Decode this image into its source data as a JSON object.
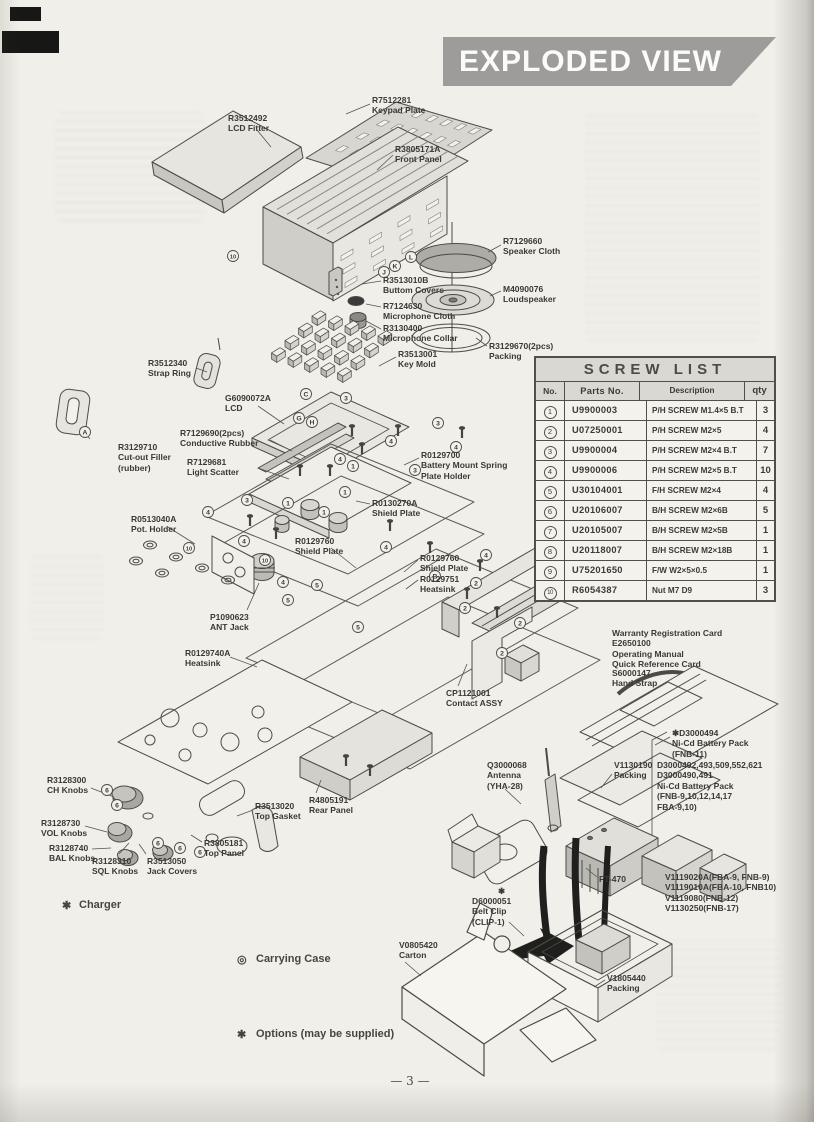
{
  "banner": {
    "title": "EXPLODED VIEW"
  },
  "page": {
    "number_text": "— 3 —"
  },
  "screw_table": {
    "title": "SCREW LIST",
    "columns": [
      "No.",
      "Parts No.",
      "Description",
      "qty"
    ],
    "rows": [
      {
        "no": "1",
        "part": "U9900003",
        "desc": "P/H SCREW M1.4×5 B.T",
        "qty": "3"
      },
      {
        "no": "2",
        "part": "U07250001",
        "desc": "P/H SCREW M2×5",
        "qty": "4"
      },
      {
        "no": "3",
        "part": "U9900004",
        "desc": "P/H SCREW M2×4 B.T",
        "qty": "7"
      },
      {
        "no": "4",
        "part": "U9900006",
        "desc": "P/H SCREW M2×5 B.T",
        "qty": "10"
      },
      {
        "no": "5",
        "part": "U30104001",
        "desc": "F/H SCREW M2×4",
        "qty": "4"
      },
      {
        "no": "6",
        "part": "U20106007",
        "desc": "B/H SCREW M2×6B",
        "qty": "5"
      },
      {
        "no": "7",
        "part": "U20105007",
        "desc": "B/H SCREW M2×5B",
        "qty": "1"
      },
      {
        "no": "8",
        "part": "U20118007",
        "desc": "B/H SCREW M2×18B",
        "qty": "1"
      },
      {
        "no": "9",
        "part": "U75201650",
        "desc": "F/W W2×5×0.5",
        "qty": "1"
      },
      {
        "no": "10",
        "part": "R6054387",
        "desc": "Nut M7 D9",
        "qty": "3"
      }
    ]
  },
  "diagram": {
    "labels": [
      {
        "id": "keypad-plate",
        "x": 372,
        "y": 95,
        "lines": [
          "R7512281",
          "Keypad Plate"
        ],
        "leader": [
          370,
          104,
          346,
          114
        ]
      },
      {
        "id": "lcd-fitter",
        "x": 228,
        "y": 113,
        "lines": [
          "R3512492",
          "LCD Fitter"
        ],
        "leader": [
          257,
          130,
          271,
          147
        ]
      },
      {
        "id": "front-panel",
        "x": 395,
        "y": 144,
        "lines": [
          "R3805171A",
          "Front Panel"
        ],
        "leader": [
          393,
          155,
          377,
          170
        ]
      },
      {
        "id": "speaker-cloth",
        "x": 503,
        "y": 236,
        "lines": [
          "R7129660",
          "Speaker Cloth"
        ],
        "leader": [
          501,
          245,
          488,
          252
        ]
      },
      {
        "id": "buttom-covers",
        "x": 383,
        "y": 275,
        "lines": [
          "R3513010B",
          "Buttom Covers"
        ],
        "leader": [
          381,
          281,
          362,
          284
        ]
      },
      {
        "id": "loudspeaker",
        "x": 503,
        "y": 284,
        "lines": [
          "M4090076",
          "Loudspeaker"
        ],
        "leader": [
          501,
          291,
          490,
          296
        ]
      },
      {
        "id": "microphone-cloth",
        "x": 383,
        "y": 301,
        "lines": [
          "R7124630",
          "Microphone Cloth"
        ],
        "leader": [
          381,
          307,
          366,
          304
        ]
      },
      {
        "id": "microphone-collar",
        "x": 383,
        "y": 323,
        "lines": [
          "R3130400",
          "Microphone Collar"
        ],
        "leader": [
          381,
          329,
          366,
          321
        ]
      },
      {
        "id": "packing-2pcs",
        "x": 489,
        "y": 341,
        "lines": [
          "R3129670(2pcs)",
          "Packing"
        ],
        "leader": [
          487,
          346,
          476,
          338
        ]
      },
      {
        "id": "key-mold",
        "x": 398,
        "y": 349,
        "lines": [
          "R3513001",
          "Key Mold"
        ],
        "leader": [
          396,
          357,
          379,
          366
        ]
      },
      {
        "id": "strap-ring",
        "x": 148,
        "y": 358,
        "lines": [
          "R3512340",
          "Strap Ring"
        ],
        "leader": [
          196,
          368,
          207,
          372
        ]
      },
      {
        "id": "lcd",
        "x": 225,
        "y": 393,
        "lines": [
          "G6090072A",
          "LCD"
        ],
        "leader": [
          258,
          406,
          284,
          424
        ]
      },
      {
        "id": "conductive-rubber",
        "x": 180,
        "y": 428,
        "lines": [
          "R7129690(2pcs)",
          "Conductive Rubber"
        ],
        "leader": [
          270,
          440,
          292,
          451
        ]
      },
      {
        "id": "cut-out-filler",
        "x": 118,
        "y": 442,
        "lines": [
          "R3129710",
          "Cut-out Filler",
          "(rubber)"
        ],
        "leader": [
          90,
          439,
          80,
          428
        ]
      },
      {
        "id": "light-scatter",
        "x": 187,
        "y": 457,
        "lines": [
          "R7129681",
          "Light Scatter"
        ],
        "leader": [
          258,
          468,
          289,
          479
        ]
      },
      {
        "id": "battery-mount-spring",
        "x": 421,
        "y": 450,
        "lines": [
          "R0129700",
          "Battery Mount Spring",
          "Plate Holder"
        ],
        "leader": [
          419,
          458,
          404,
          465
        ]
      },
      {
        "id": "shield-plate-a",
        "x": 372,
        "y": 498,
        "lines": [
          "R0130270A",
          "Shield Plate"
        ],
        "leader": [
          370,
          504,
          356,
          501
        ]
      },
      {
        "id": "pot-holder",
        "x": 131,
        "y": 514,
        "lines": [
          "R0513040A",
          "Pot. Holder"
        ],
        "leader": [
          168,
          527,
          195,
          544
        ]
      },
      {
        "id": "shield-plate-b",
        "x": 295,
        "y": 536,
        "lines": [
          "R0129760",
          "Shield Plate"
        ],
        "leader": [
          331,
          548,
          356,
          568
        ]
      },
      {
        "id": "shield-plate-c",
        "x": 420,
        "y": 553,
        "lines": [
          "R0129760",
          "Shield Plate"
        ],
        "leader": [
          418,
          560,
          404,
          572
        ]
      },
      {
        "id": "heatsink-a",
        "x": 420,
        "y": 574,
        "lines": [
          "R0129751",
          "Heatsink"
        ],
        "leader": [
          418,
          580,
          406,
          589
        ]
      },
      {
        "id": "ant-jack",
        "x": 210,
        "y": 612,
        "lines": [
          "P1090623",
          "ANT Jack"
        ],
        "leader": [
          247,
          610,
          259,
          583
        ]
      },
      {
        "id": "heatsink-b",
        "x": 185,
        "y": 648,
        "lines": [
          "R0129740A",
          "Heatsink"
        ],
        "leader": [
          230,
          657,
          257,
          667
        ]
      },
      {
        "id": "contact-assy",
        "x": 446,
        "y": 688,
        "lines": [
          "CP1121001",
          "Contact ASSY"
        ],
        "leader": [
          458,
          686,
          467,
          664
        ]
      },
      {
        "id": "documents",
        "x": 612,
        "y": 628,
        "lines": [
          "Warranty Registration Card",
          "E2650100",
          "Operating Manual",
          "Quick Reference Card"
        ],
        "leader": null
      },
      {
        "id": "hand-strap",
        "x": 612,
        "y": 668,
        "lines": [
          "S6000147",
          "Hand Strap"
        ],
        "leader": null
      },
      {
        "id": "battery-fnb11",
        "x": 672,
        "y": 728,
        "lines": [
          "✱D3000494",
          "Ni-Cd Battery Pack",
          "(FNB-11)"
        ],
        "leader": [
          670,
          737,
          655,
          745
        ]
      },
      {
        "id": "packing-v1130190",
        "x": 614,
        "y": 760,
        "lines": [
          "V1130190",
          "Packing"
        ],
        "leader": [
          612,
          774,
          601,
          788
        ]
      },
      {
        "id": "battery-multi",
        "x": 657,
        "y": 760,
        "lines": [
          "D3000492,493,509,552,621",
          "D3000490,491",
          "Ni-Cd Battery Pack",
          "(FNB-9,10,12,14,17",
          "FBA-9,10)"
        ],
        "leader": null
      },
      {
        "id": "antenna",
        "x": 487,
        "y": 760,
        "lines": [
          "Q3000068",
          "Antenna",
          "(YHA-28)"
        ],
        "leader": [
          505,
          789,
          521,
          804
        ]
      },
      {
        "id": "ft-470",
        "x": 599,
        "y": 874,
        "lines": [
          "FT-470"
        ],
        "leader": [
          597,
          877,
          586,
          868
        ]
      },
      {
        "id": "battery-variants",
        "x": 665,
        "y": 872,
        "lines": [
          "V1119020A(FBA-9, FNB-9)",
          "V1119010A(FBA-10, FNB10)",
          "V1119080(FNB-12)",
          "V1130250(FNB-17)"
        ],
        "leader": null
      },
      {
        "id": "ch-knobs",
        "x": 47,
        "y": 775,
        "lines": [
          "R3128300",
          "CH Knobs"
        ],
        "leader": [
          91,
          788,
          114,
          797
        ]
      },
      {
        "id": "vol-knobs",
        "x": 41,
        "y": 818,
        "lines": [
          "R3128730",
          "VOL Knobs"
        ],
        "leader": [
          85,
          826,
          107,
          832
        ]
      },
      {
        "id": "bal-knobs",
        "x": 49,
        "y": 843,
        "lines": [
          "R3128740",
          "BAL Knobs"
        ],
        "leader": [
          92,
          849,
          111,
          848
        ]
      },
      {
        "id": "sql-knobs",
        "x": 92,
        "y": 856,
        "lines": [
          "R3128310",
          "SQL Knobs"
        ],
        "leader": [
          119,
          854,
          129,
          843
        ]
      },
      {
        "id": "jack-covers",
        "x": 147,
        "y": 856,
        "lines": [
          "R3513050",
          "Jack Covers"
        ],
        "leader": [
          146,
          854,
          139,
          844
        ]
      },
      {
        "id": "top-gasket",
        "x": 255,
        "y": 801,
        "lines": [
          "R3513020",
          "Top Gasket"
        ],
        "leader": [
          253,
          810,
          237,
          816
        ]
      },
      {
        "id": "top-panel",
        "x": 204,
        "y": 838,
        "lines": [
          "R3805181",
          "Top Panel"
        ],
        "leader": [
          202,
          842,
          191,
          835
        ]
      },
      {
        "id": "rear-panel",
        "x": 309,
        "y": 795,
        "lines": [
          "R4805191",
          "Rear Panel"
        ],
        "leader": [
          316,
          793,
          321,
          780
        ]
      },
      {
        "id": "belt-clip",
        "x": 472,
        "y": 896,
        "lines": [
          "D6000051",
          "Belt Clip",
          "(CLIP-1)"
        ],
        "leader": [
          509,
          922,
          524,
          936
        ]
      },
      {
        "id": "carton",
        "x": 399,
        "y": 940,
        "lines": [
          "V0805420",
          "Carton"
        ],
        "leader": [
          405,
          962,
          421,
          976
        ]
      },
      {
        "id": "packing-v1805440",
        "x": 607,
        "y": 973,
        "lines": [
          "V1805440",
          "Packing"
        ],
        "leader": [
          605,
          980,
          594,
          987
        ]
      },
      {
        "id": "asterisk-mark",
        "x": 498,
        "y": 886,
        "lines": [
          "✱"
        ],
        "leader": null
      }
    ],
    "callouts": [
      {
        "t": "10",
        "x": 233,
        "y": 256
      },
      {
        "t": "L",
        "x": 411,
        "y": 257
      },
      {
        "t": "K",
        "x": 395,
        "y": 266
      },
      {
        "t": "J",
        "x": 384,
        "y": 272
      },
      {
        "t": "3",
        "x": 346,
        "y": 398
      },
      {
        "t": "C",
        "x": 306,
        "y": 394
      },
      {
        "t": "3",
        "x": 438,
        "y": 423
      },
      {
        "t": "4",
        "x": 391,
        "y": 441
      },
      {
        "t": "4",
        "x": 456,
        "y": 447
      },
      {
        "t": "G",
        "x": 299,
        "y": 418
      },
      {
        "t": "H",
        "x": 312,
        "y": 422
      },
      {
        "t": "4",
        "x": 340,
        "y": 459
      },
      {
        "t": "1",
        "x": 353,
        "y": 466
      },
      {
        "t": "3",
        "x": 415,
        "y": 470
      },
      {
        "t": "1",
        "x": 345,
        "y": 492
      },
      {
        "t": "3",
        "x": 247,
        "y": 500
      },
      {
        "t": "1",
        "x": 288,
        "y": 503
      },
      {
        "t": "1",
        "x": 324,
        "y": 512
      },
      {
        "t": "4",
        "x": 208,
        "y": 512
      },
      {
        "t": "4",
        "x": 244,
        "y": 541
      },
      {
        "t": "4",
        "x": 386,
        "y": 547
      },
      {
        "t": "10",
        "x": 189,
        "y": 548
      },
      {
        "t": "10",
        "x": 265,
        "y": 560
      },
      {
        "t": "4",
        "x": 486,
        "y": 555
      },
      {
        "t": "5",
        "x": 317,
        "y": 585
      },
      {
        "t": "5",
        "x": 288,
        "y": 600
      },
      {
        "t": "5",
        "x": 358,
        "y": 627
      },
      {
        "t": "4",
        "x": 283,
        "y": 582
      },
      {
        "t": "B",
        "x": 435,
        "y": 576
      },
      {
        "t": "2",
        "x": 476,
        "y": 583
      },
      {
        "t": "2",
        "x": 465,
        "y": 608
      },
      {
        "t": "2",
        "x": 520,
        "y": 623
      },
      {
        "t": "2",
        "x": 502,
        "y": 653
      },
      {
        "t": "A",
        "x": 85,
        "y": 432
      },
      {
        "t": "6",
        "x": 107,
        "y": 790
      },
      {
        "t": "6",
        "x": 117,
        "y": 805
      },
      {
        "t": "6",
        "x": 158,
        "y": 843
      },
      {
        "t": "6",
        "x": 180,
        "y": 848
      },
      {
        "t": "6",
        "x": 200,
        "y": 852
      }
    ]
  },
  "sections": {
    "charger": {
      "bullet": "✱",
      "title": "Charger",
      "lines": [
        "NC-27B/C (for FNB-9)",
        "B Vers. 117VAC. 50/60Hz p/n D3000480",
        "C Vers. 220/234 VAC. 50/60Hz p/n D3000481",
        "NC-28B/C (for FNB-14)",
        "B Vers. 117VAC. 60Hz p/n D3000484",
        "C Vers. 220/234 VAC. 50/60Hz p/n D3000485",
        "NC-18B/C (for FNB-10, 17)",
        "B Vers. 117VAC. 60Hz p/n D3000359",
        "C Vers. 220/234 VAC. 50/60Hz p/n D3000360",
        "NC-34B/C (for FNB-11, 12)",
        "B Vers. 117VAC. 60Hz p/n D3000571",
        "C Vers. 220/234 VAC. 50/60Hz p/n D3000572"
      ]
    },
    "carrying_case": {
      "bullet": "◎",
      "title": "Carrying Case",
      "lines": [
        "CSC-35 (for FNB-9, 17) p/n D3000614",
        "CSC-36 (for FNB-10) p/n D3000615",
        "CSC-37 (for FNB-12, 14) p/n D3000616",
        "CSC-38 (for FNB-11) p/n D3000617"
      ]
    },
    "options": {
      "bullet": "✱",
      "text": "Options (may be supplied)"
    }
  }
}
